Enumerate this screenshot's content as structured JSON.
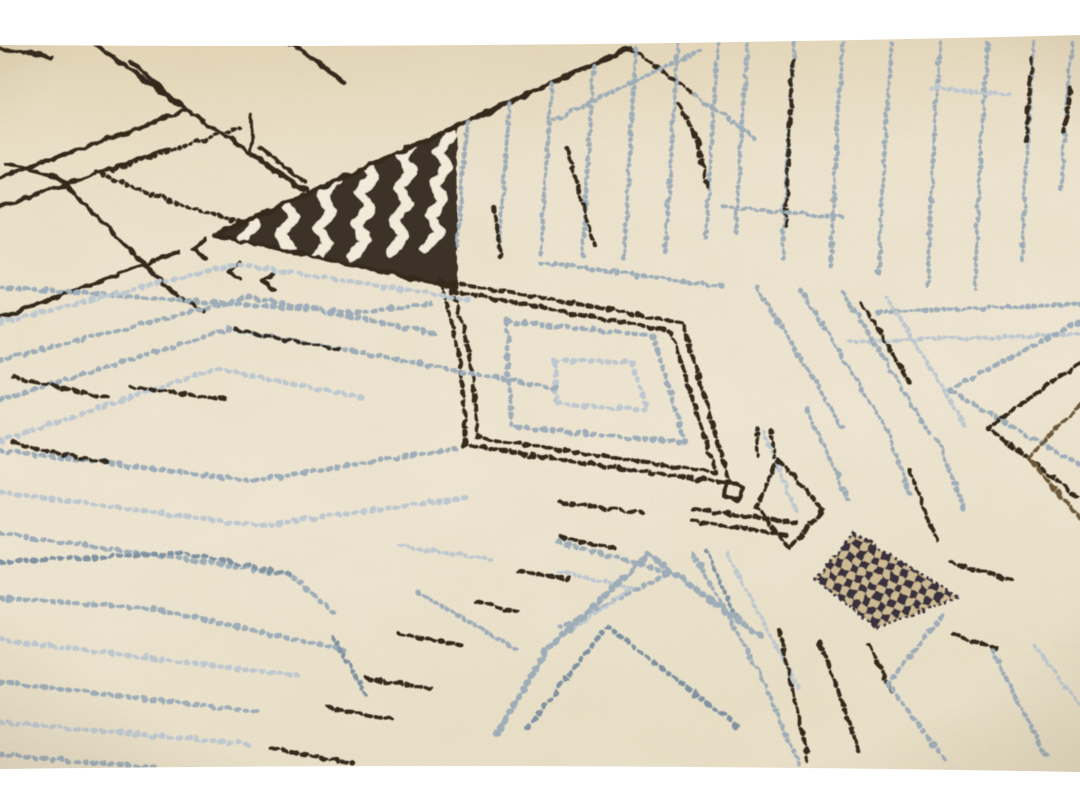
{
  "scene": {
    "type": "photograph",
    "subject": "Close-up angled photograph of a cream handmade Moroccan Beni Ourain style wool rug decorated with dark brown and blue-grey geometric tribal patterns, with plain white margins at the top and bottom",
    "style": "berber moroccan wool rug, hand-knotted",
    "elements": [
      {
        "name": "border-top",
        "desc": "plain white margin strip above the rug photograph"
      },
      {
        "name": "tile-grid",
        "desc": "dark brown hand-drawn grid of large skewed tiles in the upper left corner"
      },
      {
        "name": "dotted-outline-blob",
        "desc": "small open shape drawn in dark dotted stitches inside the grid"
      },
      {
        "name": "herringbone-triangle",
        "desc": "solid dark brown triangular patch filled with chevron herringbone stripes, pointing left"
      },
      {
        "name": "diamond-medallion",
        "desc": "large lozenge with a double dark brown dotted outline and two nested pale blue dotted lozenges inside"
      },
      {
        "name": "stepped-diamond",
        "desc": "small dark stepped diamond outline to the right of the medallion"
      },
      {
        "name": "checker-diamond",
        "desc": "diamond filled with a dark checkerboard pattern, middle right"
      },
      {
        "name": "pinstripes",
        "desc": "thin wavy near-vertical blue-grey pinstripes across the top band with occasional dark strands and horizontal tie stitches"
      },
      {
        "name": "stitch-lines",
        "desc": "long dotted blue-grey stitch lines with dark brown segments zigzagging across the lower half"
      },
      {
        "name": "nested-chevrons",
        "desc": "nested chevron corners at the right edge, below the medallion and along the bottom"
      },
      {
        "name": "border-bottom",
        "desc": "plain white margin strip below the rug photograph"
      }
    ]
  },
  "palette": {
    "frame_white": "#ffffff",
    "cream": "#f0e8d3",
    "cream_light": "#f8f2e2",
    "cream_shadow": "#e4d9bf",
    "dark_brown": "#34291b",
    "brown_mid": "#6f5c3b",
    "tan": "#b49a68",
    "blue_gray": "#a2b2bf",
    "blue_gray_light": "#c3ced7",
    "blue_gray_dark": "#8497a7",
    "checker_dark": "#3a3040",
    "checker_base": "#d3c19a"
  }
}
